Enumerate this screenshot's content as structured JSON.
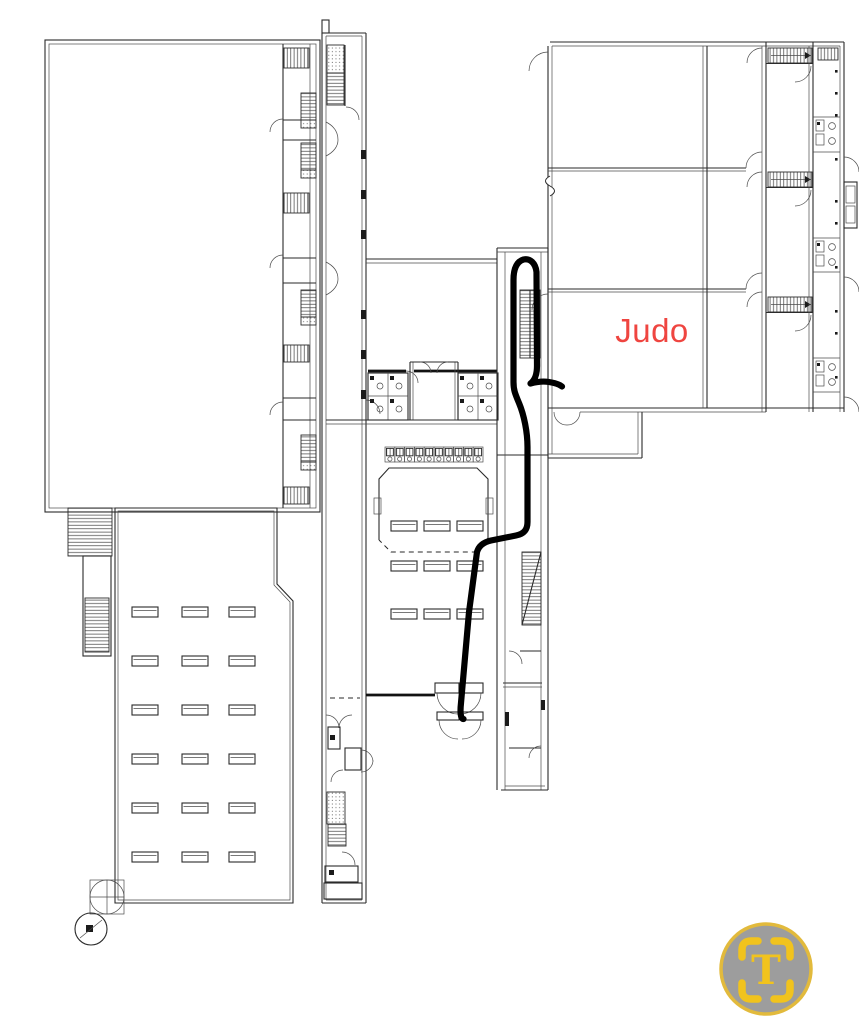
{
  "plan": {
    "room_label": "Judo",
    "label_color": "#ef4540"
  },
  "route": {
    "color": "#000000",
    "width": 6.2,
    "path": "M463.5,719 C460.5,719 460,712 461,703 L469,612 L477,552 C479,545 484.5,542 491,540.5 L516,535.5 C524,534 527.5,529.5 527.5,522 L527.5,447 C527.5,432 524,415 519,403 C515,393.5 513.5,390 513.5,382 L513.5,280 C513.5,268 517,261.5 523.5,259.5 C530,258 535.5,263 536.5,272 L537,366 C537,375 534.5,380.5 530.5,383.5 C536,382 543,381 549,382 C555.5,383 559.5,384.5 562,386.5"
  },
  "badge": {
    "letter": "T",
    "ring_color": "#e2ba3c",
    "fill_color": "#9d9d9d",
    "glyph_color": "#f1c31d"
  }
}
